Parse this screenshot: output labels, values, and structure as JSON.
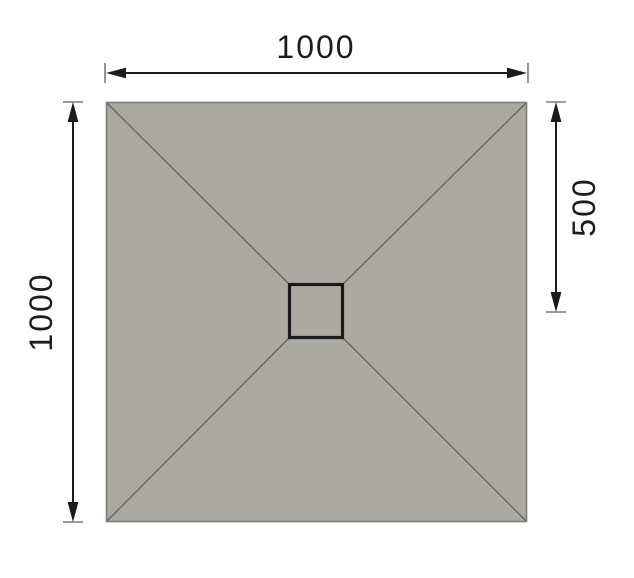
{
  "diagram": {
    "type": "square-shower-tray-dimension-drawing",
    "labels": {
      "width": "1000",
      "height": "1000",
      "half_height": "500"
    },
    "colors": {
      "background": "#ffffff",
      "tray_fill": "#abaaa2",
      "tray_outline": "#7d7c76",
      "slope_line": "#6f6f6d",
      "drain_outline": "#1b1b1b",
      "dimension_line": "#1c1c1c",
      "tick_line": "#7a7a7a",
      "label_text": "#1d1d1d"
    }
  }
}
